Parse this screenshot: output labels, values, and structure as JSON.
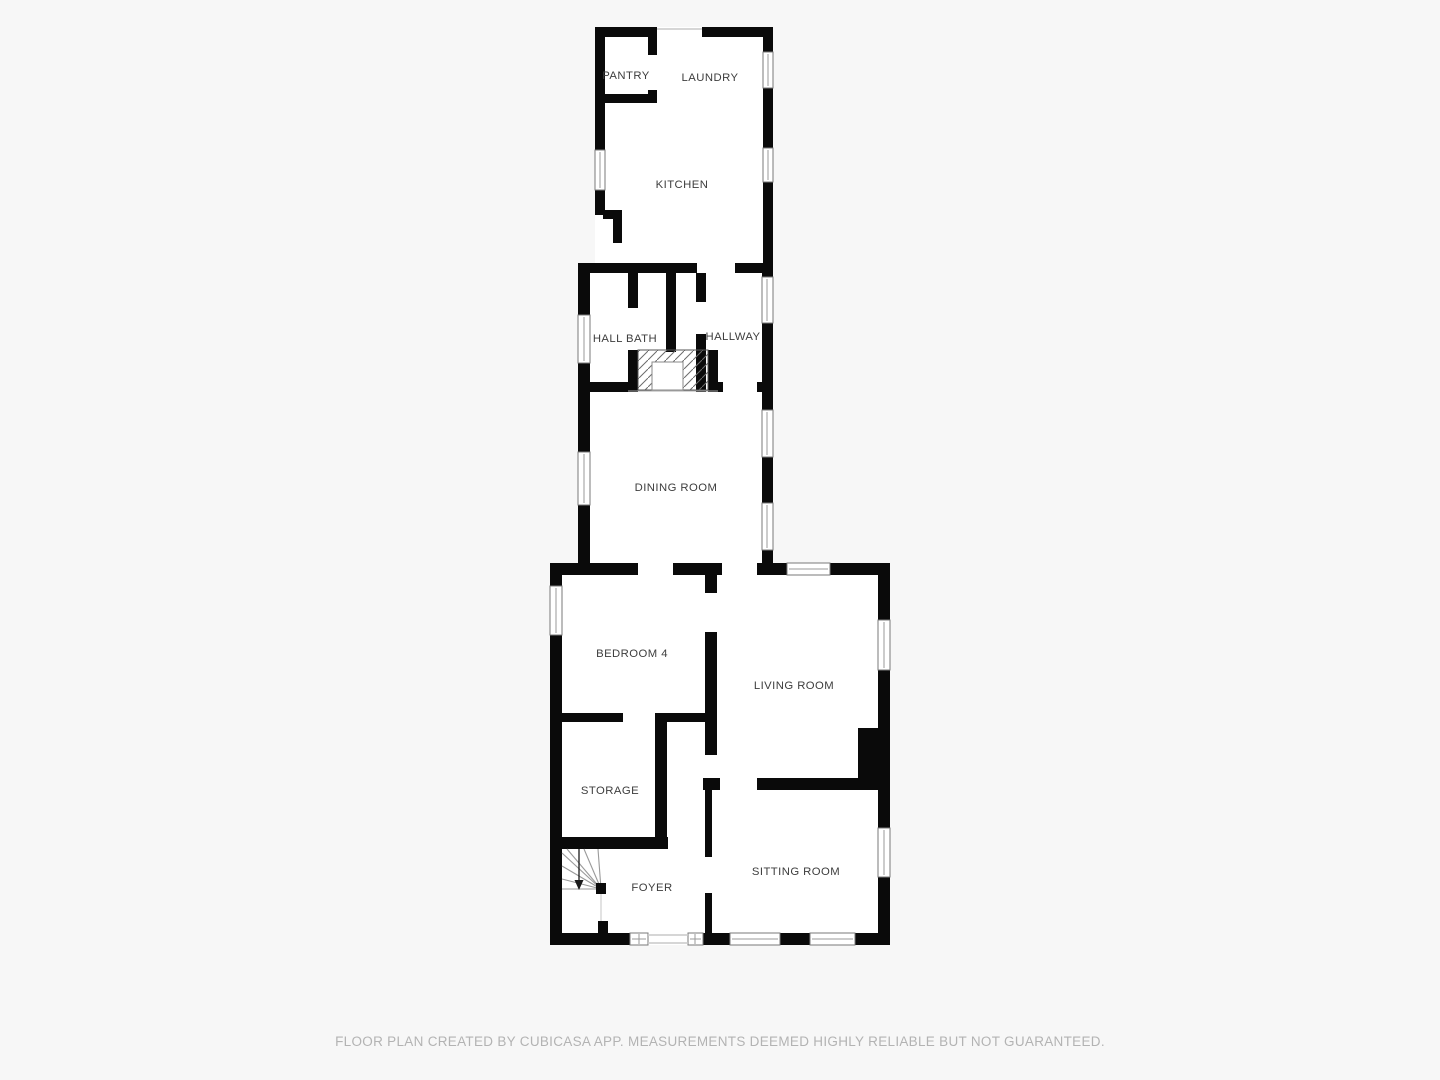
{
  "plan": {
    "source_note": "FLOOR PLAN CREATED BY CUBICASA APP. MEASUREMENTS DEEMED HIGHLY RELIABLE BUT NOT GUARANTEED.",
    "colors": {
      "background": "#f7f7f7",
      "wall": "#0a0a0a",
      "floor": "#ffffff",
      "label_text": "#3d3d3d",
      "footer_text": "#b3b3b3"
    },
    "rooms": [
      {
        "id": "pantry",
        "label": "PANTRY",
        "cx": 626,
        "cy": 79
      },
      {
        "id": "laundry",
        "label": "LAUNDRY",
        "cx": 710,
        "cy": 81
      },
      {
        "id": "kitchen",
        "label": "KITCHEN",
        "cx": 682,
        "cy": 188
      },
      {
        "id": "hall-bath",
        "label": "HALL BATH",
        "cx": 625,
        "cy": 342
      },
      {
        "id": "hallway",
        "label": "HALLWAY",
        "cx": 733,
        "cy": 340
      },
      {
        "id": "dining-room",
        "label": "DINING ROOM",
        "cx": 676,
        "cy": 491
      },
      {
        "id": "bedroom-4",
        "label": "BEDROOM 4",
        "cx": 632,
        "cy": 657
      },
      {
        "id": "living-room",
        "label": "LIVING ROOM",
        "cx": 794,
        "cy": 689
      },
      {
        "id": "storage",
        "label": "STORAGE",
        "cx": 610,
        "cy": 794
      },
      {
        "id": "foyer",
        "label": "FOYER",
        "cx": 652,
        "cy": 891
      },
      {
        "id": "sitting-room",
        "label": "SITTING ROOM",
        "cx": 796,
        "cy": 875
      }
    ],
    "features": [
      "winder-staircase-foyer",
      "chimney-hatched",
      "fireplace-living-room",
      "16-windows",
      "door-openings"
    ]
  }
}
